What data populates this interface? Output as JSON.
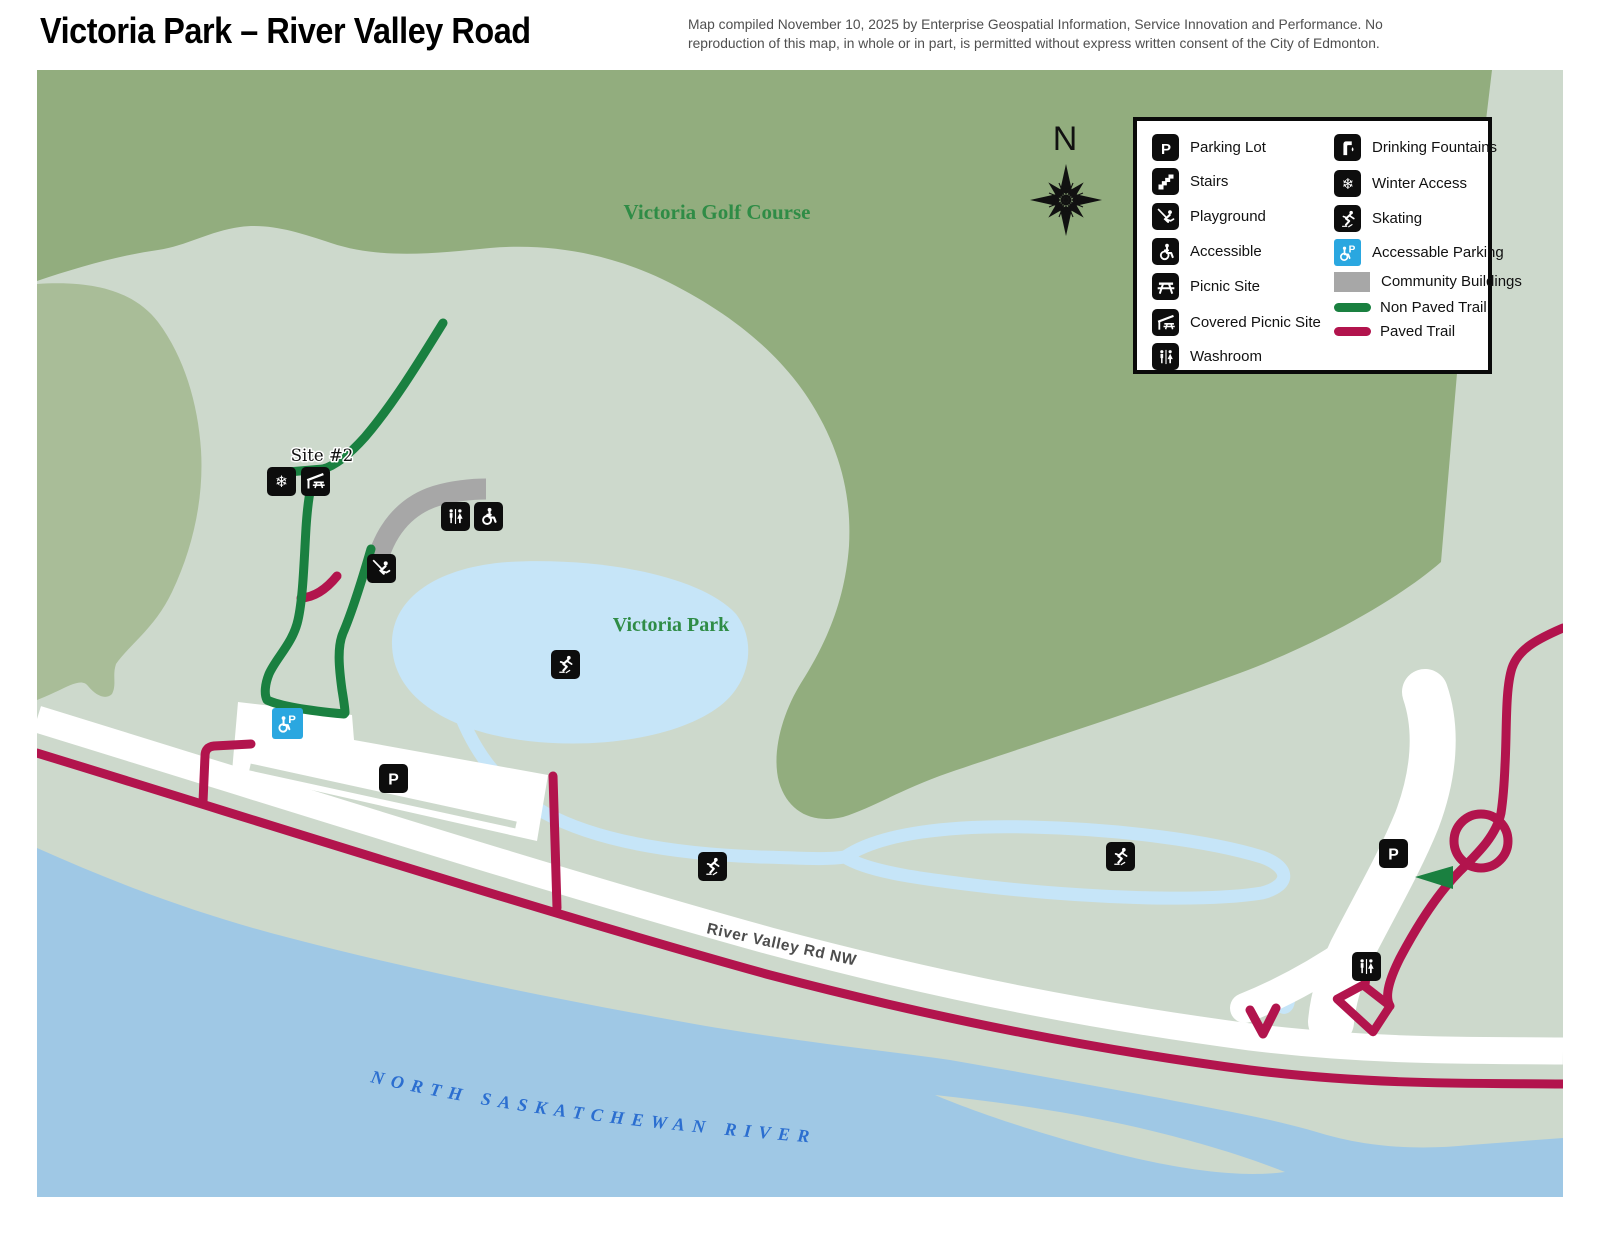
{
  "header": {
    "title": "Victoria Park – River Valley Road",
    "attribution_line1": "Map compiled November 10, 2025 by Enterprise Geospatial Information, Service Innovation and Performance. No",
    "attribution_line2": "reproduction of this map, in whole or in part, is permitted without express written consent of the City of Edmonton."
  },
  "map": {
    "labels": {
      "golf_course": "Victoria Golf Course",
      "park": "Victoria Park",
      "site": "Site #2",
      "road": "River Valley Rd NW",
      "river": "NORTH SASKATCHEWAN RIVER",
      "compass": "N"
    },
    "markers": [
      {
        "icon": "winter-access-icon"
      },
      {
        "icon": "covered-picnic-site-icon"
      },
      {
        "icon": "washroom-icon"
      },
      {
        "icon": "accessible-icon"
      },
      {
        "icon": "playground-icon"
      },
      {
        "icon": "skating-icon"
      },
      {
        "icon": "skating-icon"
      },
      {
        "icon": "skating-icon"
      },
      {
        "icon": "parking-lot-icon"
      },
      {
        "icon": "parking-lot-icon"
      },
      {
        "icon": "washroom-icon"
      },
      {
        "icon": "accessible-parking-icon"
      }
    ]
  },
  "legend": {
    "col1": [
      {
        "icon": "parking-lot-icon",
        "label": "Parking Lot"
      },
      {
        "icon": "stairs-icon",
        "label": "Stairs"
      },
      {
        "icon": "playground-icon",
        "label": "Playground"
      },
      {
        "icon": "accessible-icon",
        "label": "Accessible"
      },
      {
        "icon": "picnic-site-icon",
        "label": "Picnic Site"
      },
      {
        "icon": "covered-picnic-site-icon",
        "label": "Covered Picnic Site"
      },
      {
        "icon": "washroom-icon",
        "label": "Washroom"
      }
    ],
    "col2": [
      {
        "icon": "drinking-fountain-icon",
        "label": "Drinking Fountains"
      },
      {
        "icon": "winter-access-icon",
        "label": "Winter Access"
      },
      {
        "icon": "skating-icon",
        "label": "Skating"
      },
      {
        "icon": "accessible-parking-icon",
        "label": "Accessable Parking"
      },
      {
        "icon": "community-buildings-swatch",
        "label": "Community Buildings"
      },
      {
        "icon": "non-paved-trail-swatch",
        "label": "Non Paved Trail"
      },
      {
        "icon": "paved-trail-swatch",
        "label": "Paved Trail"
      }
    ]
  },
  "colors": {
    "golf_green": "#92ad7e",
    "parkland": "#cdd9cc",
    "light_green_band": "#a9bd98",
    "pond_blue": "#c6e5f8",
    "river_blue": "#9fc8e5",
    "non_paved_trail": "#1a8040",
    "paved_trail": "#b2144d",
    "road_white": "#ffffff",
    "community_gray": "#a7a7a7",
    "accessible_parking_blue": "#2aa7e0",
    "map_label_green": "#2f8c46",
    "river_text_blue": "#2b6ed0",
    "road_label_gray": "#4d4d4d"
  }
}
